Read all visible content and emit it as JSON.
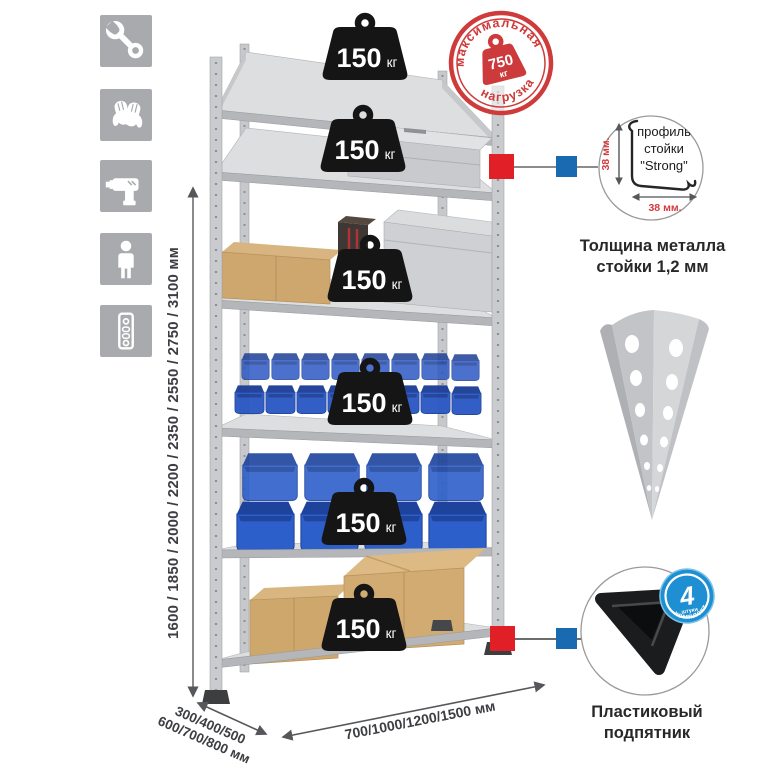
{
  "page": {
    "background": "#ffffff"
  },
  "left_icons": [
    "wrench-icon",
    "gloves-icon",
    "drill-icon",
    "person-icon",
    "rack-post-icon"
  ],
  "height_dimension": {
    "label": "1600 / 1850 / 2000 / 2200 / 2350 / 2550 / 2750 / 3100 мм"
  },
  "depth_dimension": {
    "line1": "300/400/500",
    "line2": "600/700/800 мм"
  },
  "width_dimension": {
    "label": "700/1000/1200/1500 мм"
  },
  "shelf_badges": [
    {
      "value": "150",
      "unit": "кг"
    },
    {
      "value": "150",
      "unit": "кг"
    },
    {
      "value": "150",
      "unit": "кг"
    },
    {
      "value": "150",
      "unit": "кг"
    },
    {
      "value": "150",
      "unit": "кг"
    },
    {
      "value": "150",
      "unit": "кг"
    }
  ],
  "max_load_stamp": {
    "top_text": "максимальная",
    "bottom_text": "нагрузка",
    "value": "750",
    "unit": "кг"
  },
  "profile_detail": {
    "line1": "профиль",
    "line2": "стойки",
    "line3": "\"Strong\"",
    "vertical_dim": "38 мм.",
    "horizontal_dim": "38 мм.",
    "caption1": "Толщина металла",
    "caption2": "стойки 1,2 мм"
  },
  "foot_detail": {
    "badge_number": "4",
    "badge_small_text": "штуки",
    "badge_arc_text": "в комплекте",
    "caption1": "Пластиковый",
    "caption2": "подпятник"
  },
  "colors": {
    "accent_red": "#d23a3c",
    "marker_red": "#e01f26",
    "marker_blue": "#1a6ab2",
    "bin_blue": "#2b57c0",
    "badge_blue": "#1e8fd2",
    "metal_gray": "#c9cbce",
    "icon_gray": "#a8aaad"
  }
}
